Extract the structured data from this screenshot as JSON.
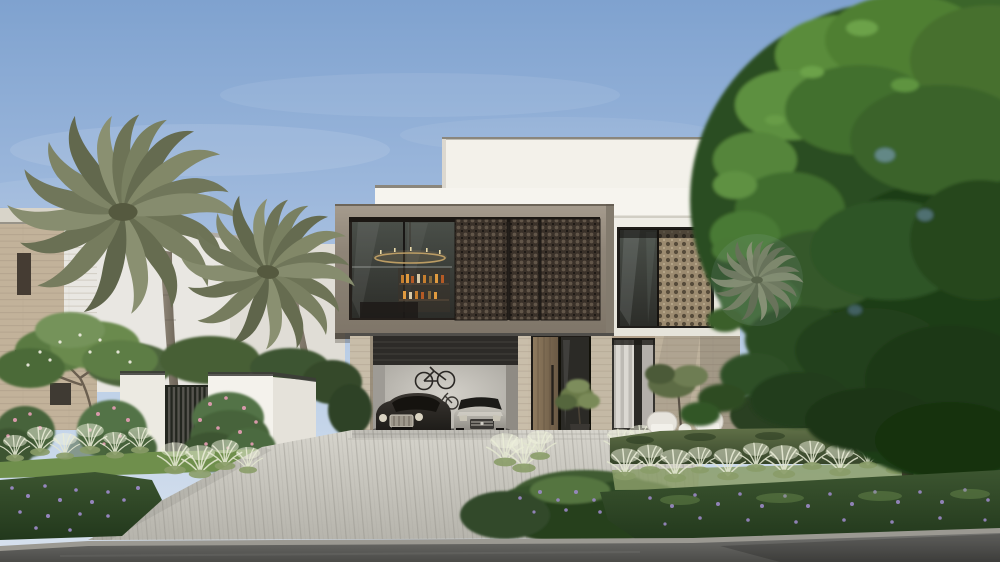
{
  "alt": "Photorealistic exterior rendering of a modern two-storey villa: white upper volumes, a taupe second-floor box with dark bronze mashrabiya screens and a glass balcony, travertine stone ground floor, open double garage with a dark coupe and a silver sedan and wall-mounted bicycles, tall wooden pivot entrance door, stepping-stone path, paver driveway, white garden wall with slatted gate, two date palms, pink oleander and purple flower beds, white plume grasses, clipped hedge with two white patio chairs, and a large shade tree on the right under a blue sky.",
  "palette": {
    "sky_top": "#7fa2cf",
    "sky_horizon": "#d8e2ee",
    "facade_white": "#f3f1ea",
    "fascia_white": "#f6f4ee",
    "facade_white_right": "#efede6",
    "upper_box_taupe": "#938a7d",
    "screen_bronze": "#3a3129",
    "screen_tan": "#9c8b70",
    "interior_dark": "#241f1b",
    "stone_travertine": "#c8bda9",
    "stone_shadowed": "#b3a28c",
    "wood_door": "#84705a",
    "garage_dark": "#2d2b28",
    "garage_wall": "#c9c6bf",
    "car_dark": "#2e2a26",
    "car_silver": "#b9b6ae",
    "neighbor_white": "#e9e7e2",
    "neighbor_tan": "#c2b29a",
    "garden_wall_white": "#f4f2ec",
    "gate_slats": "#55544e",
    "palm_frond": "#7e8468",
    "palm_trunk": "#82796c",
    "tree_green_light": "#578838",
    "tree_green_mid": "#3e6a2a",
    "tree_green_dark": "#223f19",
    "hedge_green": "#5b6b3e",
    "plume_grass": "#e9ebd9",
    "groundcover_green": "#31502a",
    "flower_purple": "#9b89c6",
    "flower_pink": "#e09cb0",
    "flower_white": "#f2f0e4",
    "lawn_green": "#6f8f4c",
    "driveway_paver": "#cbc9c1",
    "curb": "#9b9992",
    "road_asphalt": "#5b5b58",
    "chair_white": "#e6e3dc",
    "step_stone": "#d6d2c8",
    "grass_strip": "#5d7a3c",
    "pot_dark": "#3a3733"
  }
}
